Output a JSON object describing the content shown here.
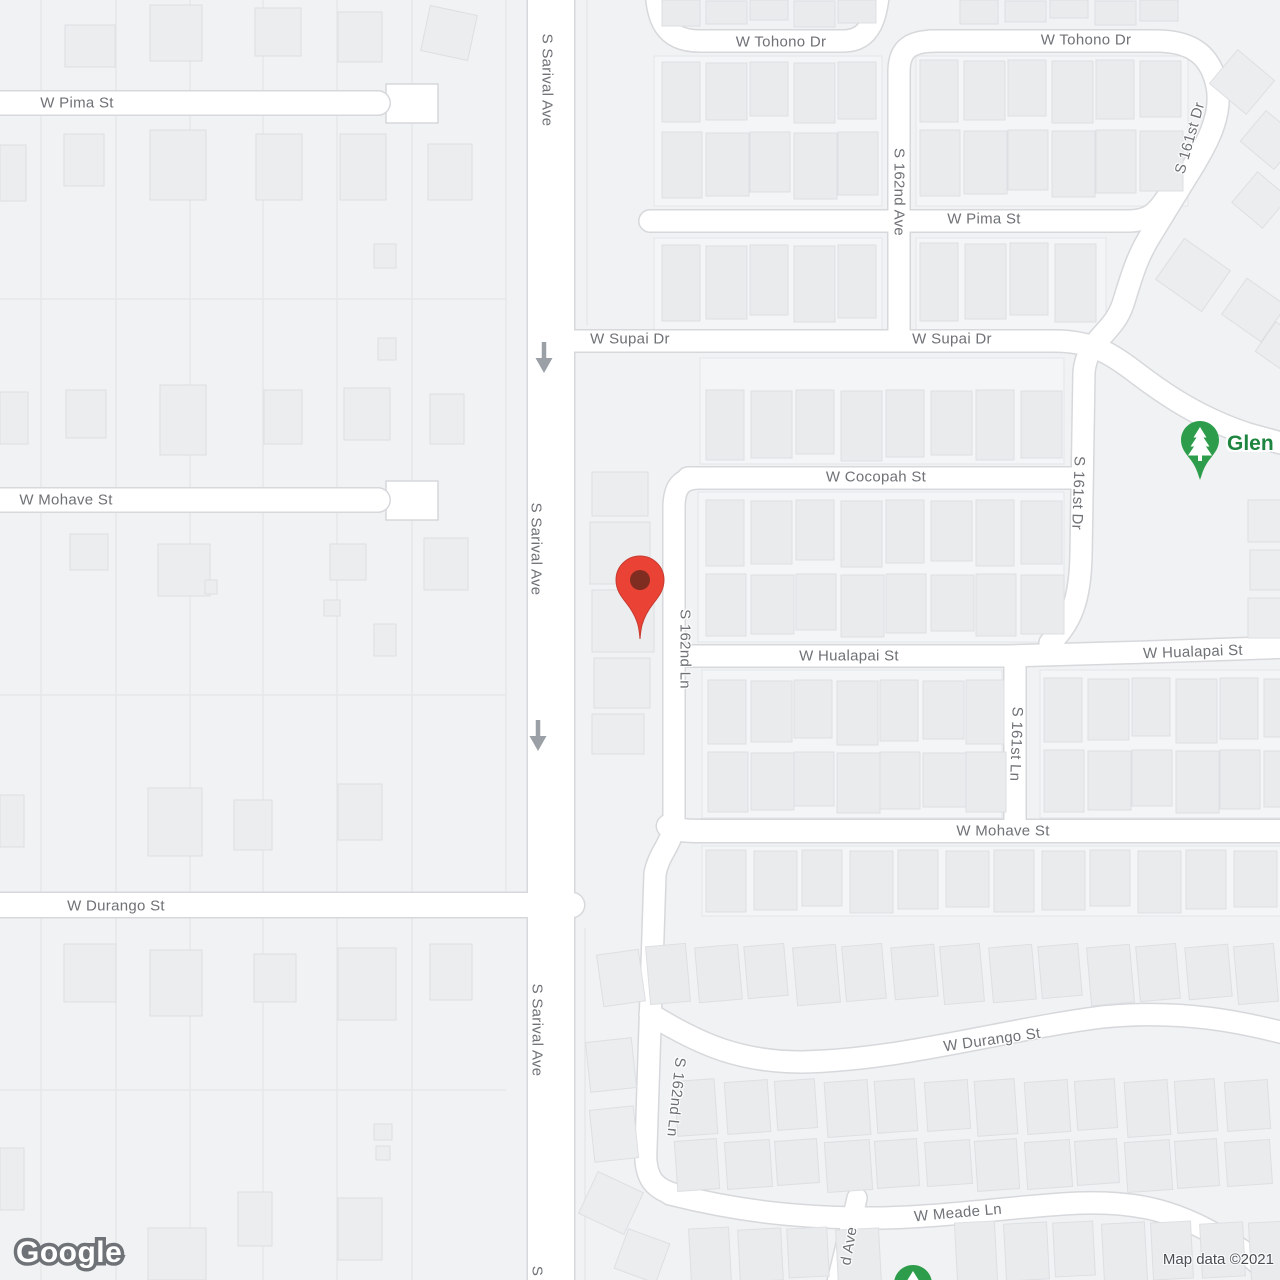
{
  "map": {
    "provider_logo": "Google",
    "attribution_text": "Map data ©2021",
    "poi": {
      "label": "Glen",
      "icon": "tree-icon",
      "color": "#1d8540"
    },
    "destination_pin": {
      "x": 640,
      "y": 580
    },
    "park_pins": [
      {
        "x": 1200,
        "y": 440
      },
      {
        "x": 913,
        "y": 1284
      }
    ],
    "one_way_arrows": [
      {
        "x": 544,
        "y": 358
      },
      {
        "x": 538,
        "y": 736
      }
    ],
    "street_labels": [
      {
        "text": "W Pima St",
        "x": 77,
        "y": 103,
        "rotation": 0
      },
      {
        "text": "S Sarival Ave",
        "x": 547,
        "y": 80,
        "rotation": 90
      },
      {
        "text": "W Tohono Dr",
        "x": 781,
        "y": 42,
        "rotation": 0
      },
      {
        "text": "W Tohono Dr",
        "x": 1086,
        "y": 40,
        "rotation": 0
      },
      {
        "text": "S 162nd Ave",
        "x": 899,
        "y": 192,
        "rotation": 90
      },
      {
        "text": "S 161st Dr",
        "x": 1190,
        "y": 138,
        "rotation": -74
      },
      {
        "text": "W Pima St",
        "x": 984,
        "y": 219,
        "rotation": 0
      },
      {
        "text": "W Supai Dr",
        "x": 630,
        "y": 339,
        "rotation": 0
      },
      {
        "text": "W Supai Dr",
        "x": 952,
        "y": 339,
        "rotation": 0
      },
      {
        "text": "W Cocopah St",
        "x": 876,
        "y": 477,
        "rotation": 0
      },
      {
        "text": "S 161st Dr",
        "x": 1078,
        "y": 493,
        "rotation": 92
      },
      {
        "text": "S Sarival Ave",
        "x": 536,
        "y": 549,
        "rotation": 90
      },
      {
        "text": "S 162nd Ln",
        "x": 685,
        "y": 649,
        "rotation": 90
      },
      {
        "text": "W Hualapai St",
        "x": 849,
        "y": 656,
        "rotation": 0
      },
      {
        "text": "W Hualapai St",
        "x": 1193,
        "y": 652,
        "rotation": -2
      },
      {
        "text": "S 161st Ln",
        "x": 1016,
        "y": 744,
        "rotation": 92
      },
      {
        "text": "W Mohave St",
        "x": 66,
        "y": 500,
        "rotation": 0
      },
      {
        "text": "W Mohave St",
        "x": 1003,
        "y": 831,
        "rotation": 0
      },
      {
        "text": "W Durango St",
        "x": 116,
        "y": 906,
        "rotation": 0
      },
      {
        "text": "S Sarival Ave",
        "x": 537,
        "y": 1030,
        "rotation": 90
      },
      {
        "text": "S 162nd Ln",
        "x": 676,
        "y": 1097,
        "rotation": 96
      },
      {
        "text": "W Durango St",
        "x": 992,
        "y": 1040,
        "rotation": -8
      },
      {
        "text": "W Meade Ln",
        "x": 958,
        "y": 1213,
        "rotation": -5
      },
      {
        "text": "d Ave",
        "x": 849,
        "y": 1246,
        "rotation": -80
      },
      {
        "text": "S",
        "x": 537,
        "y": 1271,
        "rotation": 90
      }
    ],
    "colors": {
      "land": "#f1f2f4",
      "road_fill": "#ffffff",
      "road_casing": "#d6d8db",
      "parcel_line": "#e5e7ea",
      "block_fill": "#f4f5f7",
      "block_line": "#e3e5e8",
      "building": "#e9ebed",
      "building_stroke": "#dddfe2",
      "label_text": "#6e7176",
      "pin_red": "#EA4335",
      "pin_red_dot": "#7f2c21",
      "pin_green": "#2e9d4b",
      "arrow_gray": "#9aa0a6"
    }
  }
}
